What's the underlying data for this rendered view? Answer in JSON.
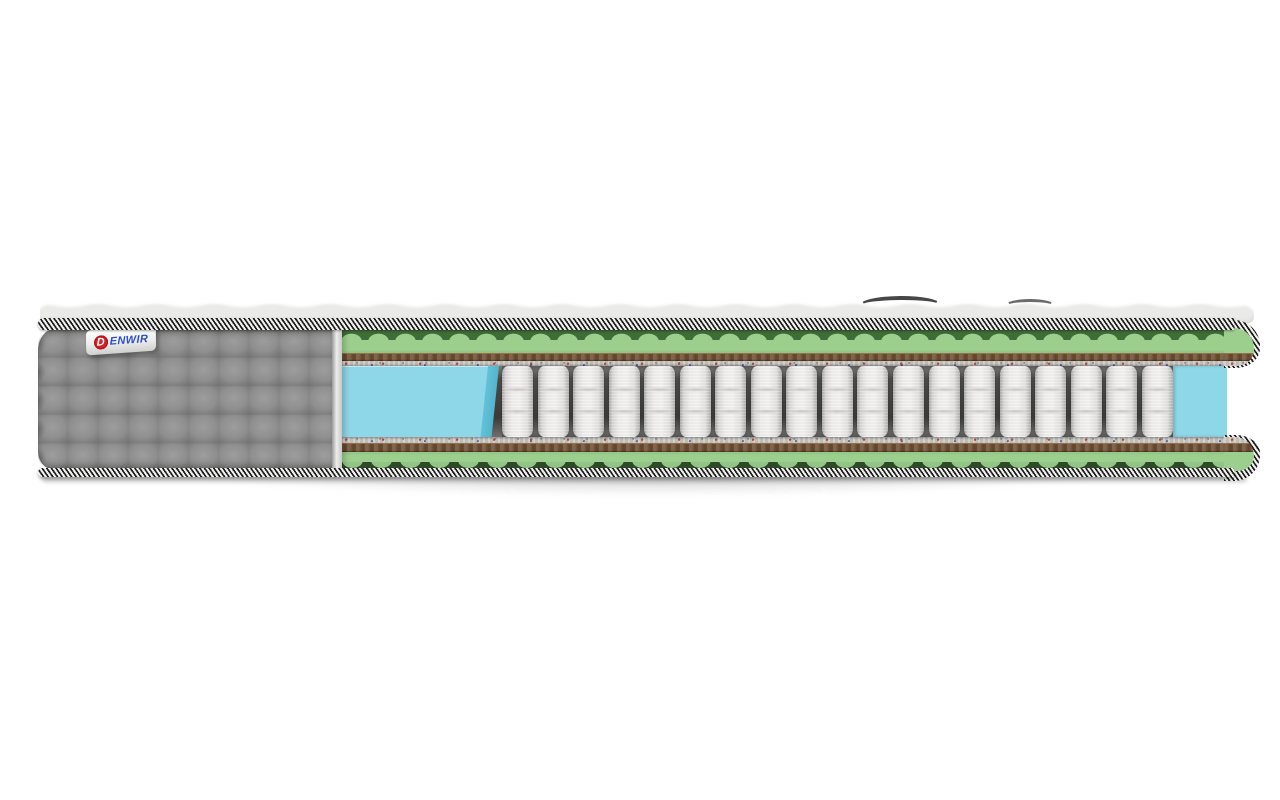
{
  "scene": {
    "description": "Cutaway product photo of a pocket-spring mattress on white background",
    "background": "#ffffff"
  },
  "brand": {
    "d": "D",
    "name_rest": "ENWIR",
    "full_name": "Denwir",
    "d_badge_color": "#d62127",
    "text_color": "#2b4ecf",
    "label_bg": "#f4f4f2"
  },
  "palette": {
    "top_fabric": "#f7f7f5",
    "piping_dark": "#1e1e1e",
    "piping_light": "#f0f0ef",
    "cover_gray": "#8d8d8d",
    "cover_gray_seam": "#727272",
    "foam_green": "#9ccf8e",
    "foam_green_dark": "#3f6c37",
    "felt_brown": "#6b4a2e",
    "fiber_gray": "#c9c6c2",
    "foam_blue": "#8ed7e8",
    "foam_blue_face": "#54b4cb",
    "spring_white": "#efeeec",
    "spring_gap_dark": "#3b3b39"
  },
  "structure": {
    "springs_count": 19,
    "quilt_cols": 10,
    "quilt_rows": 5,
    "layers_top_to_bottom": [
      {
        "name": "knit-top-cover",
        "color": "#f7f7f5"
      },
      {
        "name": "piping-binding-top",
        "color": "#1e1e1e"
      },
      {
        "name": "wavy-foam-green-top",
        "color": "#9ccf8e"
      },
      {
        "name": "coir-felt-top",
        "color": "#6b4a2e"
      },
      {
        "name": "spunbond-fiber-top",
        "color": "#c9c6c2"
      },
      {
        "name": "edge-support-foam-blue-and-pocket-springs",
        "color": "#8ed7e8"
      },
      {
        "name": "spunbond-fiber-bottom",
        "color": "#c2bfbb"
      },
      {
        "name": "coir-felt-bottom",
        "color": "#6b4a2e"
      },
      {
        "name": "wavy-foam-green-bottom",
        "color": "#9ccf8e"
      },
      {
        "name": "piping-binding-bottom",
        "color": "#1e1e1e"
      }
    ]
  }
}
